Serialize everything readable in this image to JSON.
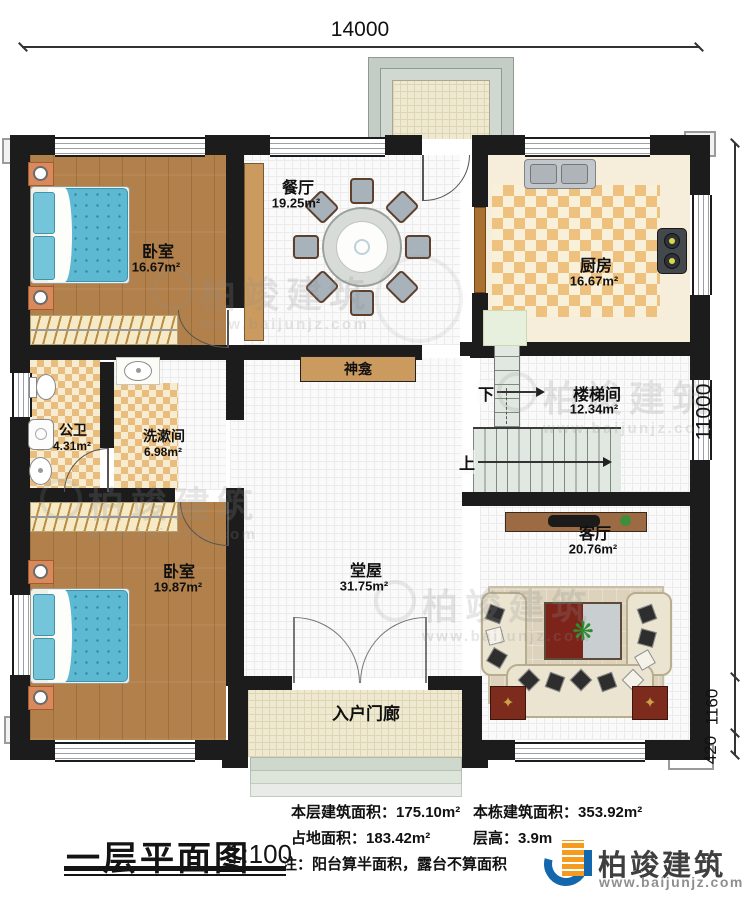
{
  "dims": {
    "top": "14000",
    "right_total": "11000",
    "right_porch": "1160",
    "right_steps": "420"
  },
  "rooms": [
    {
      "id": "bedroom1",
      "name": "卧室",
      "area": "16.67m²"
    },
    {
      "id": "dining",
      "name": "餐厅",
      "area": "19.25m²"
    },
    {
      "id": "kitchen",
      "name": "厨房",
      "area": "16.67m²"
    },
    {
      "id": "bath",
      "name": "公卫",
      "area": "4.31m²"
    },
    {
      "id": "wash",
      "name": "洗漱间",
      "area": "6.98m²"
    },
    {
      "id": "stair",
      "name": "楼梯间",
      "area": "12.34m²"
    },
    {
      "id": "bedroom2",
      "name": "卧室",
      "area": "19.87m²"
    },
    {
      "id": "hall",
      "name": "堂屋",
      "area": "31.75m²"
    },
    {
      "id": "living",
      "name": "客厅",
      "area": "20.76m²"
    },
    {
      "id": "porch",
      "name": "入户门廊",
      "area": ""
    }
  ],
  "labels": {
    "shrine": "神龛",
    "up": "上",
    "down": "下"
  },
  "footer": {
    "title": "一层平面图",
    "scale": "1:100",
    "stats": [
      {
        "label": "本层建筑面积：",
        "value": "175.10m²"
      },
      {
        "label": "本栋建筑面积：",
        "value": "353.92m²"
      },
      {
        "label": "占地面积：",
        "value": "183.42m²"
      },
      {
        "label": "层高：",
        "value": "3.9m"
      }
    ],
    "note": "注：阳台算半面积，露台不算面积"
  },
  "brand": {
    "name": "柏竣建筑",
    "url": "www.baijunjz.com",
    "blue": "#1467ac",
    "orange": "#f59b1e"
  },
  "watermark": {
    "name": "柏竣建筑",
    "url": "www.baijunjz.com"
  }
}
